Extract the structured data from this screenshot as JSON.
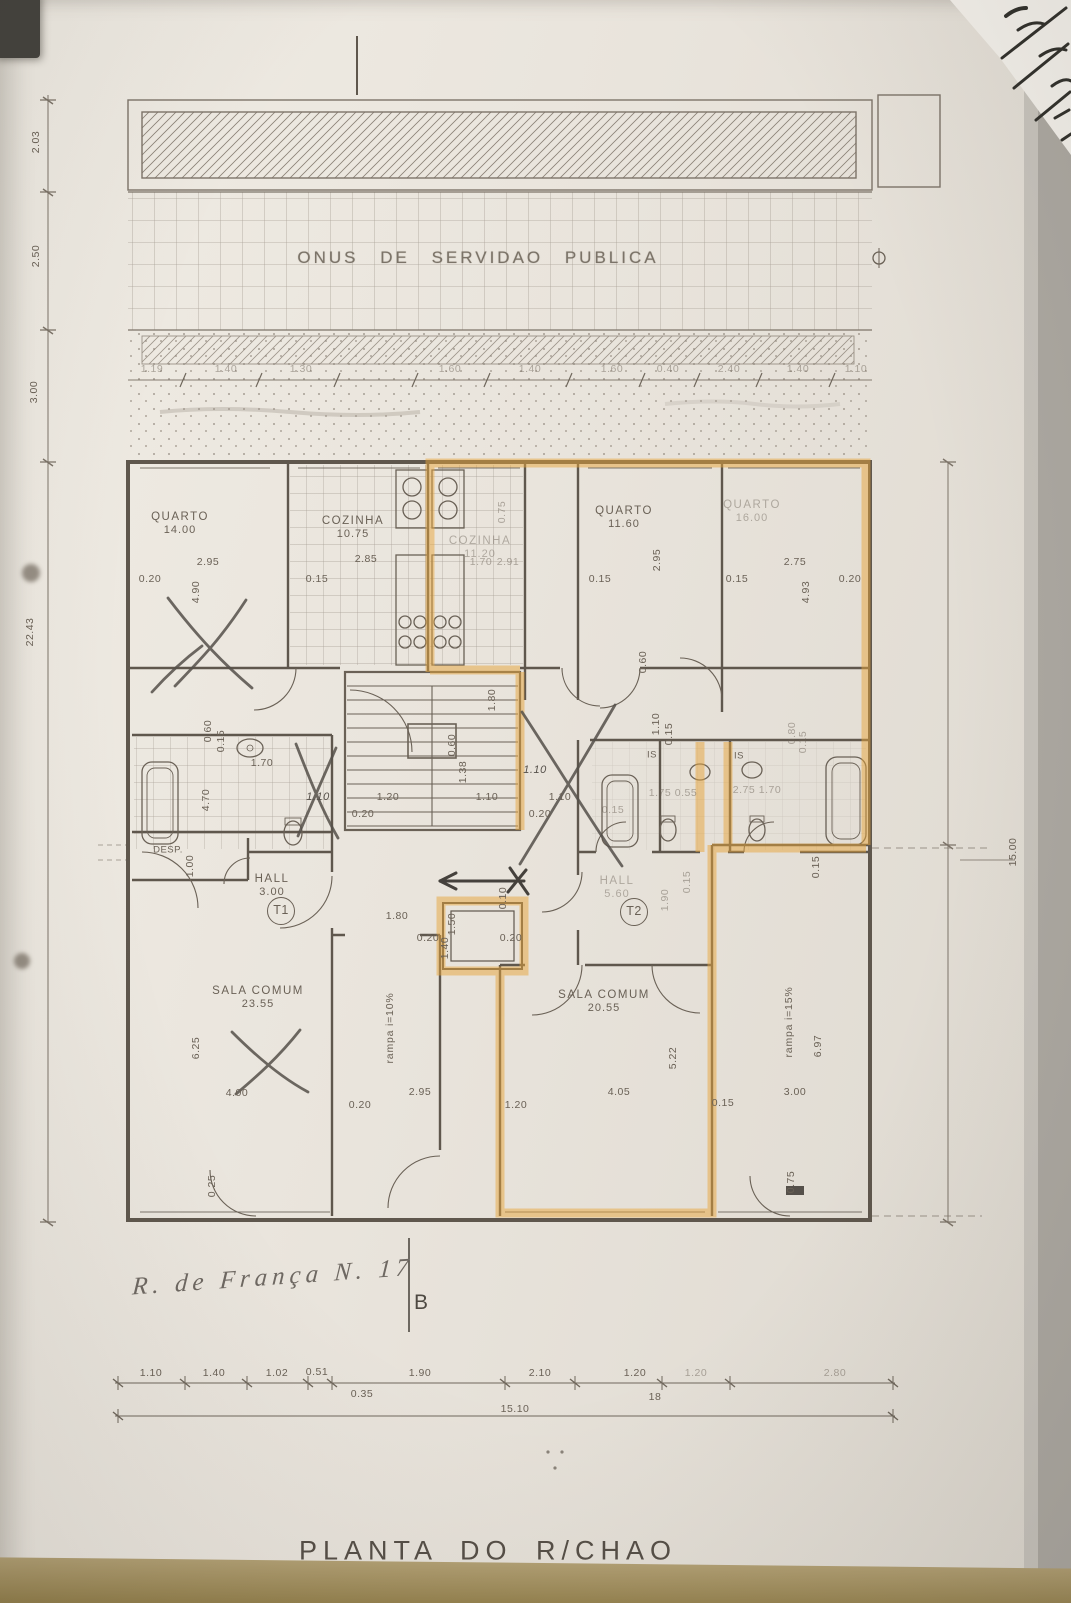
{
  "band": {
    "servitude_text": "ONUS DE SERVIDAO PUBLICA"
  },
  "titles": {
    "plan_title": "PLANTA DO R/CHAO"
  },
  "handwriting": {
    "address": "R. de França N. 17",
    "section_letter": "B"
  },
  "colors": {
    "highlight": "#e7a53c",
    "ink": "#6a6156",
    "pencil": "#55504a",
    "paper": "#eae5dd",
    "table": "#95824f"
  },
  "unit_tags": [
    {
      "t": "T1",
      "x": 281,
      "y": 911
    },
    {
      "t": "T2",
      "x": 634,
      "y": 912
    }
  ],
  "rooms": [
    {
      "name": "QUARTO",
      "area": "14.00",
      "x": 180,
      "y": 524
    },
    {
      "name": "COZINHA",
      "area": "10.75",
      "x": 353,
      "y": 528
    },
    {
      "name": "COZINHA",
      "area": "11.20",
      "x": 480,
      "y": 548,
      "faint": true
    },
    {
      "name": "QUARTO",
      "area": "11.60",
      "x": 624,
      "y": 518
    },
    {
      "name": "QUARTO",
      "area": "16.00",
      "x": 752,
      "y": 512,
      "faint": true
    },
    {
      "name": "HALL",
      "area": "3.00",
      "x": 272,
      "y": 886
    },
    {
      "name": "HALL",
      "area": "5.60",
      "x": 617,
      "y": 888,
      "faint": true
    },
    {
      "name": "DESP.",
      "area": "",
      "x": 168,
      "y": 851,
      "small": true
    },
    {
      "name": "SALA COMUM",
      "area": "23.55",
      "x": 258,
      "y": 998
    },
    {
      "name": "SALA COMUM",
      "area": "20.55",
      "x": 604,
      "y": 1002
    },
    {
      "name": "IS",
      "area": "",
      "x": 652,
      "y": 756,
      "small": true
    },
    {
      "name": "IS",
      "area": "",
      "x": 739,
      "y": 757,
      "small": true
    }
  ],
  "ramp_labels": [
    {
      "t": "rampa i=10%",
      "x": 390,
      "y": 1028
    },
    {
      "t": "rampa i=15%",
      "x": 789,
      "y": 1022
    }
  ],
  "dimensions": [
    {
      "t": "2.03",
      "x": 36,
      "y": 142,
      "r": -90
    },
    {
      "t": "2.50",
      "x": 36,
      "y": 256,
      "r": -90
    },
    {
      "t": "3.00",
      "x": 34,
      "y": 392,
      "r": -90
    },
    {
      "t": "22.43",
      "x": 30,
      "y": 632,
      "r": -90
    },
    {
      "t": "15.00",
      "x": 1013,
      "y": 852,
      "r": -90
    },
    {
      "t": "1.19",
      "x": 152,
      "y": 369,
      "f": true
    },
    {
      "t": "1.40",
      "x": 226,
      "y": 369,
      "f": true
    },
    {
      "t": "1.30",
      "x": 301,
      "y": 369,
      "f": true
    },
    {
      "t": "1.60",
      "x": 450,
      "y": 369,
      "f": true
    },
    {
      "t": "1.40",
      "x": 530,
      "y": 369,
      "f": true
    },
    {
      "t": "1.60",
      "x": 612,
      "y": 369,
      "f": true
    },
    {
      "t": "0.40",
      "x": 668,
      "y": 369,
      "f": true
    },
    {
      "t": "2.40",
      "x": 729,
      "y": 369,
      "f": true
    },
    {
      "t": "1.40",
      "x": 798,
      "y": 369,
      "f": true
    },
    {
      "t": "1.10",
      "x": 856,
      "y": 369,
      "f": true
    },
    {
      "t": "0.20",
      "x": 150,
      "y": 579
    },
    {
      "t": "2.95",
      "x": 208,
      "y": 562
    },
    {
      "t": "4.90",
      "x": 196,
      "y": 592,
      "r": -90
    },
    {
      "t": "0.15",
      "x": 317,
      "y": 579
    },
    {
      "t": "2.85",
      "x": 366,
      "y": 559
    },
    {
      "t": "0.75",
      "x": 502,
      "y": 512,
      "r": -90,
      "f": true
    },
    {
      "t": "1.70",
      "x": 481,
      "y": 562,
      "f": true
    },
    {
      "t": "2.91",
      "x": 508,
      "y": 562,
      "f": true
    },
    {
      "t": "0.15",
      "x": 600,
      "y": 579
    },
    {
      "t": "2.95",
      "x": 657,
      "y": 560,
      "r": -90
    },
    {
      "t": "0.15",
      "x": 737,
      "y": 579
    },
    {
      "t": "2.75",
      "x": 795,
      "y": 562
    },
    {
      "t": "0.20",
      "x": 850,
      "y": 579
    },
    {
      "t": "4.93",
      "x": 806,
      "y": 592,
      "r": -90
    },
    {
      "t": "0.60",
      "x": 643,
      "y": 662,
      "r": -90
    },
    {
      "t": "1.10",
      "x": 656,
      "y": 724,
      "r": -90
    },
    {
      "t": "0.15",
      "x": 669,
      "y": 734,
      "r": -90
    },
    {
      "t": "0.60",
      "x": 208,
      "y": 731,
      "r": -90
    },
    {
      "t": "0.15",
      "x": 221,
      "y": 741,
      "r": -90
    },
    {
      "t": "1.70",
      "x": 262,
      "y": 763
    },
    {
      "t": "4.70",
      "x": 206,
      "y": 800,
      "r": -90
    },
    {
      "t": "1.00",
      "x": 190,
      "y": 866,
      "r": -90
    },
    {
      "t": "1.10",
      "x": 318,
      "y": 797,
      "hand": true
    },
    {
      "t": "1.10",
      "x": 535,
      "y": 770,
      "hand": true
    },
    {
      "t": "1.80",
      "x": 492,
      "y": 700,
      "r": -90
    },
    {
      "t": "0.60",
      "x": 452,
      "y": 745,
      "r": -90
    },
    {
      "t": "1.38",
      "x": 463,
      "y": 772,
      "r": -90
    },
    {
      "t": "1.20",
      "x": 388,
      "y": 797
    },
    {
      "t": "0.20",
      "x": 363,
      "y": 814
    },
    {
      "t": "1.10",
      "x": 487,
      "y": 797
    },
    {
      "t": "1.10",
      "x": 560,
      "y": 797
    },
    {
      "t": "0.20",
      "x": 540,
      "y": 814
    },
    {
      "t": "1.75",
      "x": 660,
      "y": 793,
      "f": true
    },
    {
      "t": "0.55",
      "x": 686,
      "y": 793,
      "f": true
    },
    {
      "t": "0.15",
      "x": 613,
      "y": 810,
      "f": true
    },
    {
      "t": "1.70",
      "x": 770,
      "y": 790,
      "f": true
    },
    {
      "t": "2.75",
      "x": 744,
      "y": 790,
      "f": true
    },
    {
      "t": "0.80",
      "x": 792,
      "y": 733,
      "r": -90,
      "f": true
    },
    {
      "t": "0.15",
      "x": 803,
      "y": 742,
      "r": -90,
      "f": true
    },
    {
      "t": "1.80",
      "x": 397,
      "y": 916
    },
    {
      "t": "0.20",
      "x": 428,
      "y": 938
    },
    {
      "t": "1.50",
      "x": 452,
      "y": 924,
      "r": -90
    },
    {
      "t": "1.40",
      "x": 445,
      "y": 948,
      "r": -90
    },
    {
      "t": "0.20",
      "x": 511,
      "y": 938
    },
    {
      "t": "0.10",
      "x": 503,
      "y": 898,
      "r": -90
    },
    {
      "t": "1.90",
      "x": 665,
      "y": 900,
      "r": -90,
      "f": true
    },
    {
      "t": "0.15",
      "x": 687,
      "y": 882,
      "r": -90,
      "f": true
    },
    {
      "t": "6.25",
      "x": 196,
      "y": 1048,
      "r": -90
    },
    {
      "t": "4.00",
      "x": 237,
      "y": 1093
    },
    {
      "t": "0.25",
      "x": 212,
      "y": 1186,
      "r": -90
    },
    {
      "t": "0.20",
      "x": 360,
      "y": 1105
    },
    {
      "t": "2.95",
      "x": 420,
      "y": 1092
    },
    {
      "t": "1.20",
      "x": 516,
      "y": 1105
    },
    {
      "t": "4.05",
      "x": 619,
      "y": 1092
    },
    {
      "t": "5.22",
      "x": 673,
      "y": 1058,
      "r": -90
    },
    {
      "t": "0.15",
      "x": 723,
      "y": 1103
    },
    {
      "t": "3.00",
      "x": 795,
      "y": 1092
    },
    {
      "t": "6.97",
      "x": 818,
      "y": 1046,
      "r": -90
    },
    {
      "t": "0.15",
      "x": 816,
      "y": 867,
      "r": -90
    },
    {
      "t": "0.75",
      "x": 791,
      "y": 1182,
      "r": -90
    },
    {
      "t": "1.10",
      "x": 151,
      "y": 1373
    },
    {
      "t": "1.40",
      "x": 214,
      "y": 1373
    },
    {
      "t": "1.02",
      "x": 277,
      "y": 1373
    },
    {
      "t": "0.51",
      "x": 317,
      "y": 1372
    },
    {
      "t": "1.90",
      "x": 420,
      "y": 1373
    },
    {
      "t": "2.10",
      "x": 540,
      "y": 1373
    },
    {
      "t": "1.20",
      "x": 635,
      "y": 1373
    },
    {
      "t": "1.20",
      "x": 696,
      "y": 1373,
      "f": true
    },
    {
      "t": "2.80",
      "x": 835,
      "y": 1373,
      "f": true
    },
    {
      "t": "0.35",
      "x": 362,
      "y": 1394
    },
    {
      "t": "18",
      "x": 655,
      "y": 1397
    },
    {
      "t": "15.10",
      "x": 515,
      "y": 1409
    }
  ]
}
